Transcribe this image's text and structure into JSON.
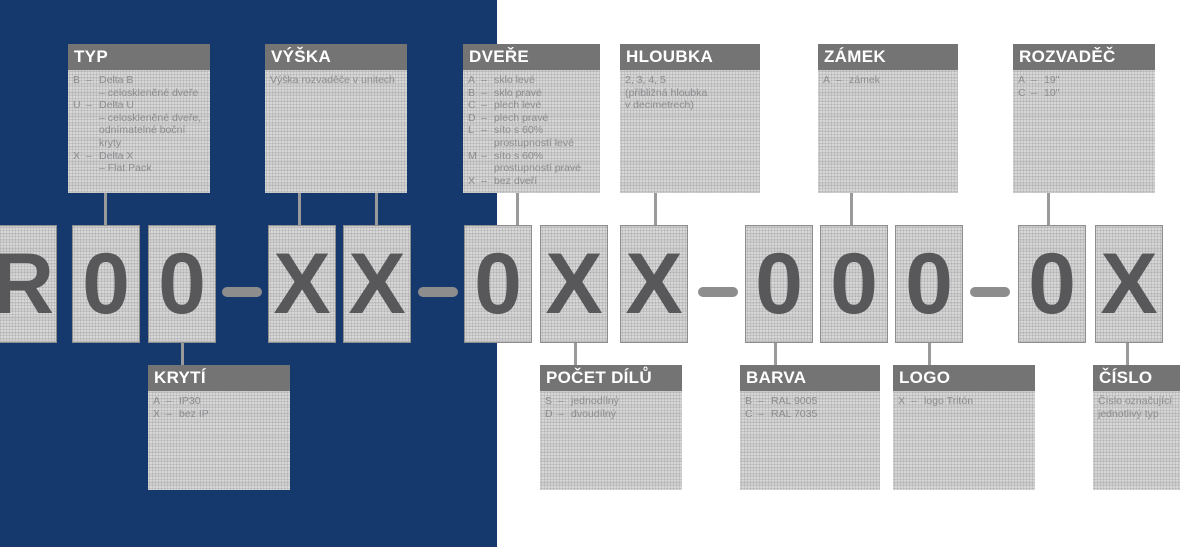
{
  "colors": {
    "panel_blue": "#15396d",
    "header_gray": "#747474",
    "box_texture_gray": "#d7d7d7",
    "letter_gray": "#58585a",
    "connector_gray": "#9a9a9a"
  },
  "code_row": {
    "chars": [
      "R",
      "0",
      "0",
      "X",
      "X",
      "0",
      "X",
      "X",
      "0",
      "0",
      "0",
      "0",
      "X"
    ],
    "separator": "–"
  },
  "callouts": {
    "typ": {
      "title": "TYP",
      "items": [
        {
          "code": "B",
          "sep": "–",
          "text": "Delta B\n– celoskleněné dveře"
        },
        {
          "code": "U",
          "sep": "–",
          "text": "Delta U\n– celoskleněné dveře,\nodnímatelné boční\nkryty"
        },
        {
          "code": "X",
          "sep": "–",
          "text": "Delta X\n– Flat Pack"
        }
      ]
    },
    "vyska": {
      "title": "VÝŠKA",
      "note": "Výška rozvaděče v unitech"
    },
    "dvere": {
      "title": "DVEŘE",
      "items": [
        {
          "code": "A",
          "sep": "–",
          "text": "sklo levé"
        },
        {
          "code": "B",
          "sep": "–",
          "text": "sklo pravé"
        },
        {
          "code": "C",
          "sep": "–",
          "text": "plech levé"
        },
        {
          "code": "D",
          "sep": "–",
          "text": "plech pravé"
        },
        {
          "code": "L",
          "sep": "–",
          "text": "síto s 60%\nprostupností levé"
        },
        {
          "code": "M",
          "sep": "–",
          "text": "síto s 60%\nprostupností pravé"
        },
        {
          "code": "X",
          "sep": "–",
          "text": "bez dveří"
        }
      ]
    },
    "hloubka": {
      "title": "HLOUBKA",
      "note": "2, 3, 4, 5\n(přibližná hloubka\nv decimetrech)"
    },
    "zamek": {
      "title": "ZÁMEK",
      "items": [
        {
          "code": "A",
          "sep": "–",
          "text": "zámek"
        }
      ]
    },
    "rozvadec": {
      "title": "ROZVADĚČ",
      "items": [
        {
          "code": "A",
          "sep": "–",
          "text": "19\""
        },
        {
          "code": "C",
          "sep": "–",
          "text": "10\""
        }
      ]
    },
    "kryti": {
      "title": "KRYTÍ",
      "items": [
        {
          "code": "A",
          "sep": "–",
          "text": "IP30"
        },
        {
          "code": "X",
          "sep": "–",
          "text": "bez IP"
        }
      ]
    },
    "pocet_dilu": {
      "title": "POČET DÍLŮ",
      "items": [
        {
          "code": "S",
          "sep": "–",
          "text": "jednodílný"
        },
        {
          "code": "D",
          "sep": "–",
          "text": "dvoudílný"
        }
      ]
    },
    "barva": {
      "title": "BARVA",
      "items": [
        {
          "code": "B",
          "sep": "–",
          "text": "RAL 9005"
        },
        {
          "code": "C",
          "sep": "–",
          "text": "RAL 7035"
        }
      ]
    },
    "logo": {
      "title": "LOGO",
      "items": [
        {
          "code": "X",
          "sep": "–",
          "text": "logo Tritón"
        }
      ]
    },
    "cislo": {
      "title": "ČÍSLO",
      "note": "Číslo označující\njednotlivý typ"
    }
  }
}
